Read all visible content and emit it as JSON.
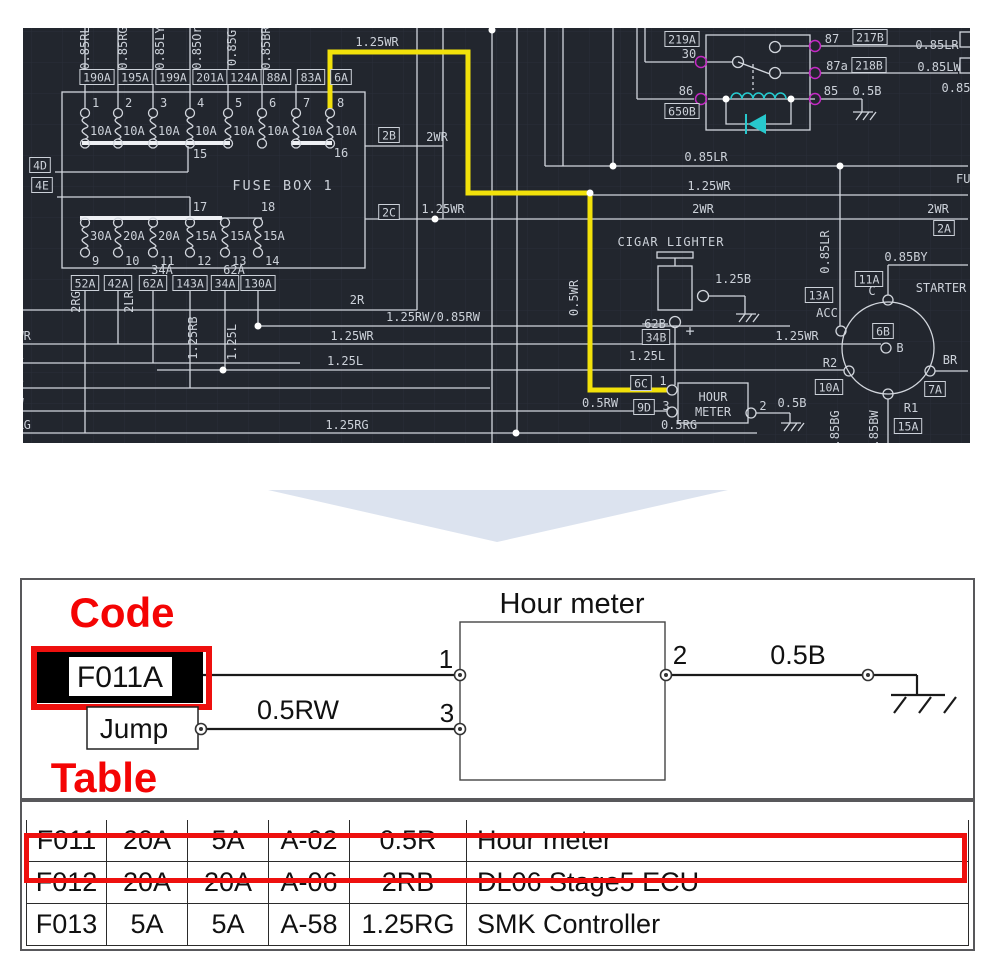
{
  "cad": {
    "bg": "#22262e",
    "grid_color": "#2a2f39",
    "wire_color": "#d2d6dd",
    "text_color": "#ccd1d9",
    "highlight_yellow": "#f2e10a",
    "pin_magenta": "#c429c4",
    "component_cyan": "#27c8cd",
    "labels": [
      {
        "t": "FUSE BOX 1",
        "x": 283,
        "y": 190,
        "s": 13.5,
        "sp": 2
      },
      {
        "t": "15",
        "x": 200,
        "y": 158
      },
      {
        "t": "16",
        "x": 341,
        "y": 157
      },
      {
        "t": "17",
        "x": 200,
        "y": 211
      },
      {
        "t": "18",
        "x": 268,
        "y": 211
      },
      {
        "t": "34A",
        "x": 162,
        "y": 274
      },
      {
        "t": "62A",
        "x": 234,
        "y": 274
      },
      {
        "t": "2R",
        "x": 357,
        "y": 304
      },
      {
        "t": "1.25RW/0.85RW",
        "x": 433,
        "y": 321
      },
      {
        "t": "1.25WR",
        "x": 352,
        "y": 340
      },
      {
        "t": "1.25WR",
        "x": 797,
        "y": 340
      },
      {
        "t": "LR",
        "x": 2,
        "y": 306,
        "a": "s"
      },
      {
        "t": "25WR",
        "x": 2,
        "y": 340,
        "a": "s"
      },
      {
        "t": "85L",
        "x": 2,
        "y": 359,
        "a": "s"
      },
      {
        "t": "5RB",
        "x": 2,
        "y": 384,
        "a": "s"
      },
      {
        "t": "5RW",
        "x": 2,
        "y": 407,
        "a": "s"
      },
      {
        "t": "85RG",
        "x": 2,
        "y": 429,
        "a": "s"
      },
      {
        "t": "1.25L",
        "x": 345,
        "y": 365
      },
      {
        "t": "1.25RG",
        "x": 347,
        "y": 429
      },
      {
        "t": "0.5RG",
        "x": 679,
        "y": 429
      },
      {
        "t": "0.5RW",
        "x": 600,
        "y": 407
      },
      {
        "t": "1.25WR",
        "x": 377,
        "y": 46
      },
      {
        "t": "2WR",
        "x": 437,
        "y": 141
      },
      {
        "t": "1.25WR",
        "x": 443,
        "y": 213
      },
      {
        "t": "2WR",
        "x": 703,
        "y": 213
      },
      {
        "t": "2WR",
        "x": 938,
        "y": 213
      },
      {
        "t": "0.85LR",
        "x": 706,
        "y": 161
      },
      {
        "t": "1.25WR",
        "x": 709,
        "y": 190
      },
      {
        "t": "FU",
        "x": 956,
        "y": 183,
        "a": "s"
      },
      {
        "t": "30",
        "x": 689,
        "y": 58
      },
      {
        "t": "86",
        "x": 686,
        "y": 95
      },
      {
        "t": "87",
        "x": 832,
        "y": 43
      },
      {
        "t": "87a",
        "x": 837,
        "y": 70
      },
      {
        "t": "85",
        "x": 831,
        "y": 95
      },
      {
        "t": "0.5B",
        "x": 867,
        "y": 95
      },
      {
        "t": "0.85LR",
        "x": 937,
        "y": 49
      },
      {
        "t": "0.85LW",
        "x": 939,
        "y": 71
      },
      {
        "t": "0.85",
        "x": 956,
        "y": 92
      },
      {
        "t": "CIGAR LIGHTER",
        "x": 671,
        "y": 246,
        "sp": 1
      },
      {
        "t": "1.25B",
        "x": 733,
        "y": 283
      },
      {
        "t": "62B",
        "x": 655,
        "y": 328,
        "k": 1
      },
      {
        "t": "+",
        "x": 690,
        "y": 336,
        "s": 15
      },
      {
        "t": "1.25L",
        "x": 647,
        "y": 360
      },
      {
        "t": "ACC",
        "x": 827,
        "y": 317
      },
      {
        "t": "0.85BY",
        "x": 906,
        "y": 261
      },
      {
        "t": "STARTER",
        "x": 941,
        "y": 292
      },
      {
        "t": "C",
        "x": 872,
        "y": 295
      },
      {
        "t": "B",
        "x": 900,
        "y": 352
      },
      {
        "t": "R2",
        "x": 830,
        "y": 367
      },
      {
        "t": "BR",
        "x": 950,
        "y": 364
      },
      {
        "t": "R1",
        "x": 911,
        "y": 412
      },
      {
        "t": "HOUR",
        "x": 713,
        "y": 401
      },
      {
        "t": "METER",
        "x": 713,
        "y": 416
      },
      {
        "t": "1",
        "x": 663,
        "y": 385
      },
      {
        "t": "3",
        "x": 666,
        "y": 410
      },
      {
        "t": "2",
        "x": 763,
        "y": 410
      },
      {
        "t": "0.5B",
        "x": 792,
        "y": 407
      },
      {
        "t": "0.85RL",
        "x": 89,
        "y": 48,
        "r": 1
      },
      {
        "t": "0.85RG",
        "x": 127,
        "y": 48,
        "r": 1
      },
      {
        "t": "0.85LY",
        "x": 164,
        "y": 48,
        "r": 1
      },
      {
        "t": "0.85Or",
        "x": 201,
        "y": 48,
        "r": 1
      },
      {
        "t": "0.85G",
        "x": 236,
        "y": 48,
        "r": 1
      },
      {
        "t": "0.85BR",
        "x": 270,
        "y": 48,
        "r": 1
      },
      {
        "t": "2RG",
        "x": 80,
        "y": 302,
        "r": 1
      },
      {
        "t": "2LR",
        "x": 133,
        "y": 302,
        "r": 1
      },
      {
        "t": "1.25RB",
        "x": 197,
        "y": 338,
        "r": 1
      },
      {
        "t": "1.25L",
        "x": 236,
        "y": 342,
        "r": 1
      },
      {
        "t": "0.5WR",
        "x": 578,
        "y": 298,
        "r": 1
      },
      {
        "t": "0.85LR",
        "x": 829,
        "y": 252,
        "r": 1
      },
      {
        "t": "0.85BG",
        "x": 839,
        "y": 432,
        "r": 1
      },
      {
        "t": "0.85BW",
        "x": 878,
        "y": 432,
        "r": 1
      }
    ],
    "boxed_labels": [
      {
        "t": "190A",
        "x": 97,
        "y": 77
      },
      {
        "t": "195A",
        "x": 135,
        "y": 77
      },
      {
        "t": "199A",
        "x": 173,
        "y": 77
      },
      {
        "t": "201A",
        "x": 210,
        "y": 77
      },
      {
        "t": "124A",
        "x": 244,
        "y": 77
      },
      {
        "t": "88A",
        "x": 277,
        "y": 77
      },
      {
        "t": "83A",
        "x": 311,
        "y": 77
      },
      {
        "t": "6A",
        "x": 341,
        "y": 77
      },
      {
        "t": "4D",
        "x": 40,
        "y": 165
      },
      {
        "t": "4E",
        "x": 42,
        "y": 185
      },
      {
        "t": "52A",
        "x": 85,
        "y": 283
      },
      {
        "t": "42A",
        "x": 118,
        "y": 283
      },
      {
        "t": "62A",
        "x": 153,
        "y": 283
      },
      {
        "t": "143A",
        "x": 190,
        "y": 283
      },
      {
        "t": "34A",
        "x": 225,
        "y": 283
      },
      {
        "t": "130A",
        "x": 258,
        "y": 283
      },
      {
        "t": "2B",
        "x": 389,
        "y": 135
      },
      {
        "t": "2C",
        "x": 389,
        "y": 212
      },
      {
        "t": "219A",
        "x": 682,
        "y": 39
      },
      {
        "t": "650B",
        "x": 682,
        "y": 111
      },
      {
        "t": "217B",
        "x": 870,
        "y": 37
      },
      {
        "t": "218B",
        "x": 869,
        "y": 65
      },
      {
        "t": "2A",
        "x": 944,
        "y": 228
      },
      {
        "t": "13A",
        "x": 819,
        "y": 295
      },
      {
        "t": "11A",
        "x": 869,
        "y": 279
      },
      {
        "t": "6B",
        "x": 883,
        "y": 331
      },
      {
        "t": "10A",
        "x": 829,
        "y": 387
      },
      {
        "t": "7A",
        "x": 935,
        "y": 389
      },
      {
        "t": "15A",
        "x": 908,
        "y": 426
      },
      {
        "t": "34B",
        "x": 656,
        "y": 337
      },
      {
        "t": "6C",
        "x": 641,
        "y": 383
      },
      {
        "t": "9D",
        "x": 644,
        "y": 407
      }
    ],
    "fuse_rows": [
      {
        "xs": [
          85,
          118,
          153,
          190,
          228,
          262,
          296,
          330
        ],
        "numbers": [
          "1",
          "2",
          "3",
          "4",
          "5",
          "6",
          "7",
          "8"
        ],
        "amps": [
          "10A",
          "10A",
          "10A",
          "10A",
          "10A",
          "10A",
          "10A",
          "10A"
        ],
        "y_top": 113,
        "y_bot": 143.5,
        "y_num": 107,
        "y_amp": 135,
        "num_side": "top"
      },
      {
        "xs": [
          85,
          118,
          153,
          190,
          225,
          258
        ],
        "numbers": [
          "9",
          "10",
          "11",
          "12",
          "13",
          "14"
        ],
        "amps": [
          "30A",
          "20A",
          "20A",
          "15A",
          "15A",
          "15A"
        ],
        "y_top": 222.5,
        "y_bot": 252.5,
        "y_num": 265,
        "y_amp": 240,
        "num_side": "bottom"
      }
    ]
  },
  "transition_arrow": {
    "color": "#dce3ef"
  },
  "callout": {
    "red": "#f40404",
    "code_heading": "Code",
    "table_heading": "Table",
    "fuse_code": "F011A",
    "jump_label": "Jump",
    "component_title": "Hour meter",
    "pin1": "1",
    "pin2": "2",
    "pin3": "3",
    "wire_left": "0.5RW",
    "wire_right": "0.5B"
  },
  "table": {
    "highlighted_row": 0,
    "rows": [
      [
        "F011",
        "20A",
        "5A",
        "A-02",
        "0.5R",
        "Hour meter"
      ],
      [
        "F012",
        "20A",
        "20A",
        "A-06",
        "2RB",
        "DL06 Stage5 ECU"
      ],
      [
        "F013",
        "5A",
        "5A",
        "A-58",
        "1.25RG",
        "SMK Controller"
      ]
    ]
  }
}
